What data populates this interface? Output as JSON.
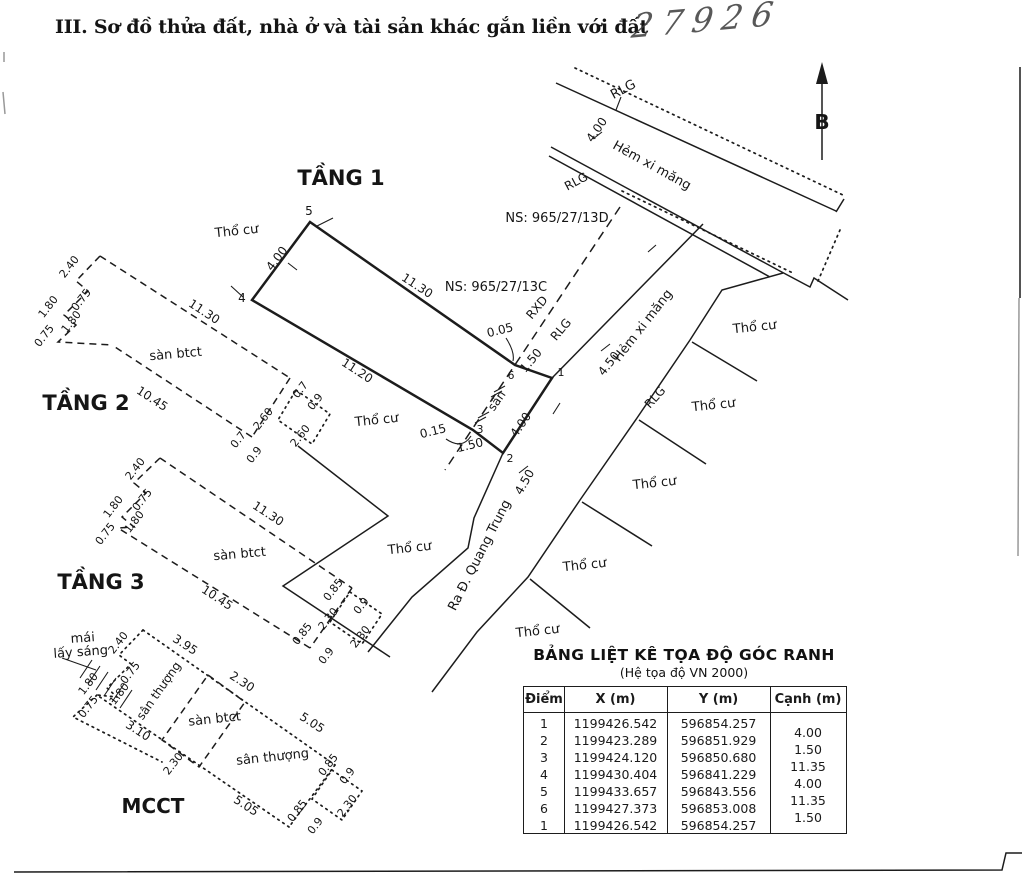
{
  "header": {
    "section_title": "III. Sơ đồ thửa đất, nhà ở và tài sản khác gắn liền với đất",
    "handwritten_number": "27926"
  },
  "table": {
    "title": "BẢNG LIỆT KÊ TỌA ĐỘ GÓC RANH",
    "subtitle": "(Hệ tọa độ VN 2000)",
    "columns": [
      "Điểm",
      "X (m)",
      "Y (m)",
      "Cạnh (m)"
    ],
    "rows": [
      [
        "1",
        "1199426.542",
        "596854.257"
      ],
      [
        "2",
        "1199423.289",
        "596851.929"
      ],
      [
        "3",
        "1199424.120",
        "596850.680"
      ],
      [
        "4",
        "1199430.404",
        "596841.229"
      ],
      [
        "5",
        "1199433.657",
        "596843.556"
      ],
      [
        "6",
        "1199427.373",
        "596853.008"
      ],
      [
        "1",
        "1199426.542",
        "596854.257"
      ]
    ],
    "canh_values": [
      "4.00",
      "1.50",
      "11.35",
      "4.00",
      "11.35",
      "1.50"
    ]
  },
  "diagram": {
    "labels": [
      {
        "t": "TẦNG 1",
        "x": 341,
        "y": 185,
        "r": 0,
        "s": 21,
        "b": 1,
        "n": "floor1-title"
      },
      {
        "t": "TẦNG 2",
        "x": 86,
        "y": 410,
        "r": 0,
        "s": 21,
        "b": 1,
        "n": "floor2-title"
      },
      {
        "t": "TẦNG 3",
        "x": 101,
        "y": 589,
        "r": 0,
        "s": 21,
        "b": 1,
        "n": "floor3-title"
      },
      {
        "t": "MCCT",
        "x": 153,
        "y": 813,
        "r": 0,
        "s": 20,
        "b": 1,
        "n": "mcct-title"
      },
      {
        "t": "B",
        "x": 822,
        "y": 129,
        "r": 0,
        "s": 20,
        "b": 1,
        "f": 1,
        "n": "north-label"
      },
      {
        "t": "Thổ cư",
        "x": 237,
        "y": 235,
        "r": -6,
        "s": 13,
        "n": "land-use-label"
      },
      {
        "t": "Thổ cư",
        "x": 377,
        "y": 424,
        "r": -6,
        "s": 13,
        "n": "land-use-label"
      },
      {
        "t": "Thổ cư",
        "x": 410,
        "y": 552,
        "r": -6,
        "s": 13,
        "n": "land-use-label"
      },
      {
        "t": "Thổ cư",
        "x": 755,
        "y": 331,
        "r": -6,
        "s": 13,
        "n": "land-use-label"
      },
      {
        "t": "Thổ cư",
        "x": 714,
        "y": 409,
        "r": -6,
        "s": 13,
        "n": "land-use-label"
      },
      {
        "t": "Thổ cư",
        "x": 655,
        "y": 487,
        "r": -6,
        "s": 13,
        "n": "land-use-label"
      },
      {
        "t": "Thổ cư",
        "x": 585,
        "y": 569,
        "r": -6,
        "s": 13,
        "n": "land-use-label"
      },
      {
        "t": "Thổ cư",
        "x": 538,
        "y": 635,
        "r": -6,
        "s": 13,
        "n": "land-use-label"
      },
      {
        "t": "NS: 965/27/13D",
        "x": 557,
        "y": 222,
        "r": 0,
        "s": 13,
        "n": "house-number-label"
      },
      {
        "t": "NS: 965/27/13C",
        "x": 496,
        "y": 291,
        "r": 0,
        "s": 13,
        "n": "house-number-label"
      },
      {
        "t": "RLG",
        "x": 625,
        "y": 93,
        "r": -28,
        "s": 13,
        "n": "boundary-code-label"
      },
      {
        "t": "RLG",
        "x": 578,
        "y": 185,
        "r": -28,
        "s": 12,
        "n": "boundary-code-label"
      },
      {
        "t": "RXD",
        "x": 540,
        "y": 310,
        "r": -50,
        "s": 12,
        "n": "boundary-code-label"
      },
      {
        "t": "RLG",
        "x": 564,
        "y": 332,
        "r": -50,
        "s": 12,
        "n": "boundary-code-label"
      },
      {
        "t": "RLG",
        "x": 658,
        "y": 400,
        "r": -48,
        "s": 12,
        "n": "boundary-code-label"
      },
      {
        "t": "Hẻm xi măng",
        "x": 650,
        "y": 169,
        "r": 29,
        "s": 13,
        "n": "alley-name-label"
      },
      {
        "t": "Hẻm xi măng",
        "x": 646,
        "y": 328,
        "r": -52,
        "s": 13,
        "n": "alley-name-label"
      },
      {
        "t": "Ra Đ. Quang Trung",
        "x": 483,
        "y": 557,
        "r": -63,
        "s": 13,
        "n": "road-name-label"
      },
      {
        "t": "4.00",
        "x": 600,
        "y": 132,
        "r": -55,
        "s": 12,
        "n": "dim"
      },
      {
        "t": "4.50",
        "x": 612,
        "y": 366,
        "r": -52,
        "s": 12,
        "n": "dim"
      },
      {
        "t": "4.50",
        "x": 528,
        "y": 484,
        "r": -60,
        "s": 12,
        "n": "dim"
      },
      {
        "t": "11.30",
        "x": 415,
        "y": 289,
        "r": 33,
        "s": 12,
        "n": "dim"
      },
      {
        "t": "11.20",
        "x": 355,
        "y": 374,
        "r": 33,
        "s": 12,
        "n": "dim"
      },
      {
        "t": "4.00",
        "x": 280,
        "y": 261,
        "r": -53,
        "s": 12,
        "n": "dim"
      },
      {
        "t": "0.05",
        "x": 501,
        "y": 334,
        "r": -14,
        "s": 12,
        "n": "dim"
      },
      {
        "t": "1.50",
        "x": 534,
        "y": 363,
        "r": -50,
        "s": 12,
        "n": "dim"
      },
      {
        "t": "sân",
        "x": 500,
        "y": 403,
        "r": -55,
        "s": 12,
        "n": "area-label"
      },
      {
        "t": "4.00",
        "x": 524,
        "y": 427,
        "r": -55,
        "s": 12,
        "n": "dim"
      },
      {
        "t": "0.15",
        "x": 434,
        "y": 435,
        "r": -14,
        "s": 12,
        "n": "dim"
      },
      {
        "t": "1.50",
        "x": 471,
        "y": 449,
        "r": -14,
        "s": 12,
        "n": "dim"
      },
      {
        "t": "5",
        "x": 309,
        "y": 215,
        "r": 0,
        "s": 12,
        "n": "point-number"
      },
      {
        "t": "4",
        "x": 242,
        "y": 302,
        "r": 0,
        "s": 12,
        "n": "point-number"
      },
      {
        "t": "6",
        "x": 511,
        "y": 379,
        "r": 0,
        "s": 11,
        "n": "point-number"
      },
      {
        "t": "1",
        "x": 561,
        "y": 376,
        "r": 0,
        "s": 11,
        "n": "point-number"
      },
      {
        "t": "3",
        "x": 480,
        "y": 433,
        "r": 0,
        "s": 11,
        "n": "point-number"
      },
      {
        "t": "2",
        "x": 510,
        "y": 462,
        "r": 0,
        "s": 11,
        "n": "point-number"
      },
      {
        "t": "2.40",
        "x": 72,
        "y": 269,
        "r": -52,
        "s": 11,
        "n": "dim"
      },
      {
        "t": "0.75",
        "x": 84,
        "y": 302,
        "r": -52,
        "s": 11,
        "n": "dim"
      },
      {
        "t": "1.80",
        "x": 51,
        "y": 309,
        "r": -52,
        "s": 11,
        "n": "dim"
      },
      {
        "t": "1.80",
        "x": 74,
        "y": 324,
        "r": -52,
        "s": 11,
        "n": "dim"
      },
      {
        "t": "0.75",
        "x": 47,
        "y": 338,
        "r": -52,
        "s": 11,
        "n": "dim"
      },
      {
        "t": "11.30",
        "x": 202,
        "y": 315,
        "r": 33,
        "s": 12,
        "n": "dim"
      },
      {
        "t": "sàn btct",
        "x": 176,
        "y": 358,
        "r": -5,
        "s": 13,
        "n": "area-label"
      },
      {
        "t": "10.45",
        "x": 150,
        "y": 402,
        "r": 33,
        "s": 12,
        "n": "dim"
      },
      {
        "t": "0.7",
        "x": 303,
        "y": 392,
        "r": -52,
        "s": 11,
        "n": "dim"
      },
      {
        "t": "0.9",
        "x": 318,
        "y": 404,
        "r": -52,
        "s": 11,
        "n": "dim"
      },
      {
        "t": "2.60",
        "x": 266,
        "y": 421,
        "r": -52,
        "s": 11,
        "n": "dim"
      },
      {
        "t": "0.7",
        "x": 241,
        "y": 442,
        "r": -52,
        "s": 11,
        "n": "dim"
      },
      {
        "t": "0.9",
        "x": 257,
        "y": 457,
        "r": -52,
        "s": 11,
        "n": "dim"
      },
      {
        "t": "2.60",
        "x": 303,
        "y": 438,
        "r": -52,
        "s": 11,
        "n": "dim"
      },
      {
        "t": "2.40",
        "x": 138,
        "y": 471,
        "r": -52,
        "s": 11,
        "n": "dim"
      },
      {
        "t": "0.75",
        "x": 145,
        "y": 502,
        "r": -52,
        "s": 11,
        "n": "dim"
      },
      {
        "t": "1.80",
        "x": 116,
        "y": 509,
        "r": -52,
        "s": 11,
        "n": "dim"
      },
      {
        "t": "1.80",
        "x": 137,
        "y": 524,
        "r": -52,
        "s": 11,
        "n": "dim"
      },
      {
        "t": "0.75",
        "x": 108,
        "y": 536,
        "r": -52,
        "s": 11,
        "n": "dim"
      },
      {
        "t": "11.30",
        "x": 266,
        "y": 517,
        "r": 33,
        "s": 12,
        "n": "dim"
      },
      {
        "t": "sàn btct",
        "x": 240,
        "y": 558,
        "r": -5,
        "s": 13,
        "n": "area-label"
      },
      {
        "t": "10.45",
        "x": 215,
        "y": 601,
        "r": 33,
        "s": 12,
        "n": "dim"
      },
      {
        "t": "0.85",
        "x": 336,
        "y": 592,
        "r": -52,
        "s": 11,
        "n": "dim"
      },
      {
        "t": "0.9",
        "x": 364,
        "y": 608,
        "r": -52,
        "s": 11,
        "n": "dim"
      },
      {
        "t": "2.30",
        "x": 331,
        "y": 621,
        "r": -52,
        "s": 11,
        "n": "dim"
      },
      {
        "t": "0.85",
        "x": 305,
        "y": 636,
        "r": -52,
        "s": 11,
        "n": "dim"
      },
      {
        "t": "0.9",
        "x": 329,
        "y": 658,
        "r": -52,
        "s": 11,
        "n": "dim"
      },
      {
        "t": "2.30",
        "x": 363,
        "y": 639,
        "r": -52,
        "s": 11,
        "n": "dim"
      },
      {
        "t": "mái",
        "x": 83,
        "y": 642,
        "r": -4,
        "s": 13,
        "n": "area-label"
      },
      {
        "t": "lấy sáng",
        "x": 81,
        "y": 656,
        "r": -4,
        "s": 13,
        "n": "area-label"
      },
      {
        "t": "2.40",
        "x": 121,
        "y": 645,
        "r": -52,
        "s": 11,
        "n": "dim"
      },
      {
        "t": "3.95",
        "x": 183,
        "y": 648,
        "r": 33,
        "s": 12,
        "n": "dim"
      },
      {
        "t": "0.75",
        "x": 133,
        "y": 675,
        "r": -52,
        "s": 11,
        "n": "dim"
      },
      {
        "t": "1.80",
        "x": 91,
        "y": 686,
        "r": -52,
        "s": 11,
        "n": "dim"
      },
      {
        "t": "1.80",
        "x": 122,
        "y": 696,
        "r": -52,
        "s": 11,
        "n": "dim"
      },
      {
        "t": "0.75",
        "x": 91,
        "y": 709,
        "r": -52,
        "s": 11,
        "n": "dim"
      },
      {
        "t": "3.10",
        "x": 136,
        "y": 734,
        "r": 33,
        "s": 12,
        "n": "dim"
      },
      {
        "t": "sân thượng",
        "x": 162,
        "y": 693,
        "r": -55,
        "s": 12,
        "n": "area-label"
      },
      {
        "t": "2.30",
        "x": 240,
        "y": 685,
        "r": 33,
        "s": 12,
        "n": "dim"
      },
      {
        "t": "sàn btct",
        "x": 215,
        "y": 723,
        "r": -6,
        "s": 13,
        "n": "area-label"
      },
      {
        "t": "5.05",
        "x": 310,
        "y": 726,
        "r": 33,
        "s": 12,
        "n": "dim"
      },
      {
        "t": "sân thượng",
        "x": 273,
        "y": 761,
        "r": -6,
        "s": 13,
        "n": "area-label"
      },
      {
        "t": "2.30",
        "x": 176,
        "y": 766,
        "r": -52,
        "s": 11,
        "n": "dim"
      },
      {
        "t": "5.05",
        "x": 244,
        "y": 809,
        "r": 33,
        "s": 12,
        "n": "dim"
      },
      {
        "t": "0.85",
        "x": 331,
        "y": 767,
        "r": -52,
        "s": 11,
        "n": "dim"
      },
      {
        "t": "0.9",
        "x": 350,
        "y": 778,
        "r": -52,
        "s": 11,
        "n": "dim"
      },
      {
        "t": "2.30",
        "x": 350,
        "y": 808,
        "r": -52,
        "s": 11,
        "n": "dim"
      },
      {
        "t": "0.85",
        "x": 300,
        "y": 813,
        "r": -52,
        "s": 11,
        "n": "dim"
      },
      {
        "t": "0.9",
        "x": 318,
        "y": 828,
        "r": -52,
        "s": 11,
        "n": "dim"
      }
    ]
  }
}
